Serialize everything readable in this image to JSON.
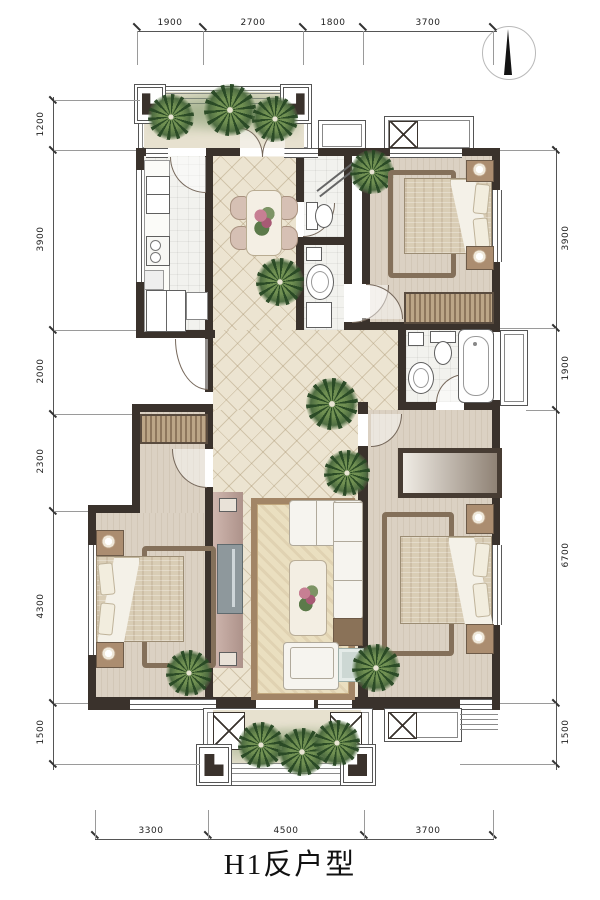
{
  "title": {
    "text": "H1反户型"
  },
  "dimensions": {
    "top": [
      "1900",
      "2700",
      "1800",
      "3700"
    ],
    "left": [
      "1200",
      "3900",
      "2000",
      "2300",
      "4300",
      "1500"
    ],
    "right": [
      "3900",
      "1900",
      "6700",
      "1500"
    ],
    "bottom": [
      "3300",
      "4500",
      "3700"
    ]
  },
  "compass": {
    "direction": "up"
  },
  "icons": {
    "compass_needle": "north-arrow",
    "ac_unit": "x-box",
    "plant": "potted-plant"
  },
  "colors": {
    "wall": "#3a322c",
    "tile_floor": "#ece4d1",
    "wood_floor": "#d9cfc1",
    "wet_floor": "#f2f2ee",
    "balcony_floor": "#e7e1cf",
    "wood_accent": "#84705a",
    "plant": "#47653c",
    "sofa": "#f6f4ef",
    "tv_cabinet": "#c7aea6",
    "rug": "#a28566"
  }
}
